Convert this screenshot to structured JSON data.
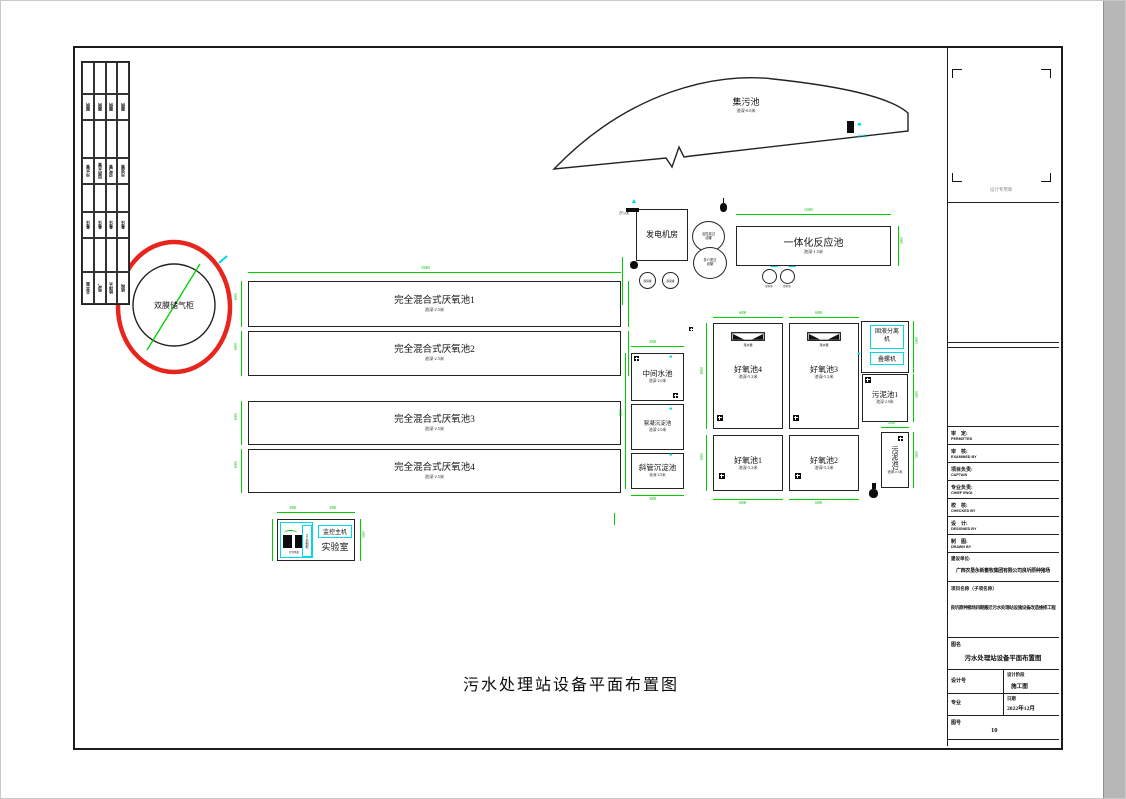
{
  "sheet": {
    "main_title": "污水处理站设备平面布置图"
  },
  "legend": {
    "rows": [
      [
        "图例",
        "图例",
        "图例",
        "图例"
      ],
      [
        "污水管",
        "加药水管",
        "沼气管",
        "污泥管"
      ],
      [
        "备注",
        "备注",
        "备注",
        "备注"
      ],
      [
        "总平面",
        "电气",
        "给排水",
        "结构"
      ]
    ]
  },
  "equip": {
    "gas_holder": "双膜储气柜",
    "collection": {
      "name": "集污池",
      "depth": "池深-6.0米"
    },
    "anaerobic": [
      {
        "name": "完全混合式厌氧池1",
        "depth": "池深-2.5米"
      },
      {
        "name": "完全混合式厌氧池2",
        "depth": "池深-2.5米"
      },
      {
        "name": "完全混合式厌氧池3",
        "depth": "池深-2.5米"
      },
      {
        "name": "完全混合式厌氧池4",
        "depth": "池深-2.5米"
      }
    ],
    "generator": "发电机房",
    "desulfurizer": "脱硫罐",
    "filter_top": "活性炭过滤罐",
    "filter_bottom": "多介质过滤罐",
    "integrated": {
      "name": "一体化反应池",
      "depth": "池深-1.5米"
    },
    "intermediate": {
      "name": "中间水池",
      "depth": "池深-2.0米"
    },
    "flocculation": {
      "name": "絮凝沉淀池",
      "depth": "池深-2.0米"
    },
    "inclined": {
      "name": "斜管沉淀池",
      "depth": "池深-2.0米"
    },
    "aerobic": [
      {
        "name": "好氧池4",
        "depth": "池深-5.2米",
        "decanter": "滗水器"
      },
      {
        "name": "好氧池3",
        "depth": "池深-5.2米",
        "decanter": "滗水器"
      },
      {
        "name": "好氧池1",
        "depth": "池深-5.2米"
      },
      {
        "name": "好氧池2",
        "depth": "池深-5.2米"
      }
    ],
    "separator": "固液分离机",
    "screw": "叠螺机",
    "sludge1": {
      "name": "污泥池1",
      "depth": "池深-2.0米"
    },
    "sludge2": {
      "name": "污泥池2",
      "depth": "池深-2.5米"
    },
    "lab": {
      "name": "实验室",
      "monitor": "监控主机",
      "cabinet": "PLC控制柜",
      "blower": "罗茨风机"
    },
    "flare": "沼气火炬",
    "pump": "提升泵"
  },
  "dims": {
    "anaerobic_len": "33000",
    "anaerobic_w": "6000",
    "integrated_len": "12000",
    "integrated_w": "3000",
    "aerobic_w": "6000",
    "aerobic_h": "8000",
    "aerobic_h2": "5000",
    "mid_w": "3000",
    "mid_h": "8000",
    "incl_b": "3000",
    "sep_h": "3000",
    "sludge1_h": "3000",
    "sludge2_w": "2000",
    "sludge2_h": "3500",
    "lab_w1": "3000",
    "lab_w2": "3000",
    "lab_h": "3000"
  },
  "title_block": {
    "stamp": "设计专用章",
    "rows": [
      {
        "cn": "审　定:",
        "en": "PERMITTED"
      },
      {
        "cn": "审　核:",
        "en": "EXAMINED BY"
      },
      {
        "cn": "项目负责:",
        "en": "CAPTAIN"
      },
      {
        "cn": "专业负责:",
        "en": "CHIEF ENGI."
      },
      {
        "cn": "校　核:",
        "en": "CHECKED BY"
      },
      {
        "cn": "设　计:",
        "en": "DESIGNED BY"
      },
      {
        "cn": "制　图:",
        "en": "DRAWN BY"
      }
    ],
    "owner_label": "建设单位:",
    "owner": "广西农垦永新畜牧集团有限公司良圻原种猪场",
    "project_label": "项目名称（子项名称）",
    "project": "良圻原种猪场四期搬迁污水处理站设施设备改造维修工程",
    "drawing_label": "图名",
    "drawing_title": "污水处理站设备平面布置图",
    "design_no_label": "设计号",
    "stage_label": "设计阶段",
    "stage": "施工图",
    "major_label": "专业",
    "date_label": "日期",
    "date": "2022年12月",
    "sheet_no_label": "图号",
    "sheet_no": "10"
  }
}
